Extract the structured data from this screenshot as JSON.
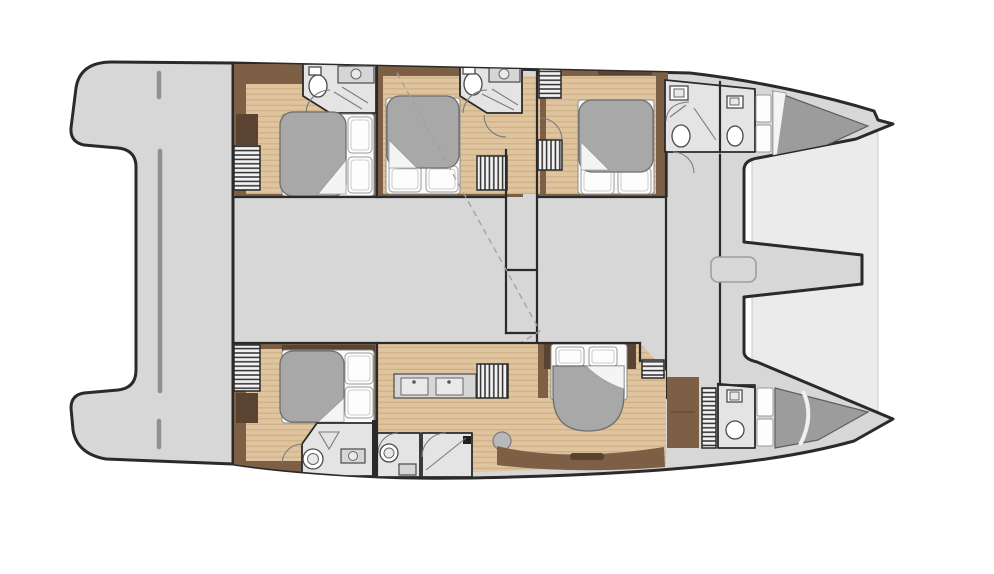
{
  "image": {
    "kind": "yacht-floor-plan",
    "vessel": "catamaran",
    "view": "interior deck plan, bows to the right",
    "background": "#ffffff"
  },
  "palette": {
    "line": "#2a2a2a",
    "deck": "#d7d7d7",
    "underlay": "#ebebeb",
    "bath": "#e4e4e4",
    "trim": "#7d5f46",
    "trim_dark": "#5a4330",
    "wood": "#dfc49e",
    "wood_grain": "#cbae85",
    "duvet": "#a8a8a8",
    "crew_bed": "#9c9c9c",
    "linen": "#fbfbfb",
    "counter": "#d6d6d6",
    "hatch_bg": "#f2f2f2",
    "hatch_line": "#2e2e2e",
    "dash": "#a0a0a0",
    "platform_line": "#909090",
    "fixture_stroke": "#4a4a4a"
  },
  "plan": {
    "double_berth_cabins": 5,
    "bow_berths": 2,
    "hulls": 2
  },
  "labels": {
    "plan": "Catamaran interior deck plan",
    "aft_platform": "Aft platform",
    "hull_top": "Hull accommodations (upper)",
    "hull_bottom": "Hull accommodations (lower)",
    "foredeck": "Foredeck and bows",
    "corridor": "Central corridor"
  }
}
